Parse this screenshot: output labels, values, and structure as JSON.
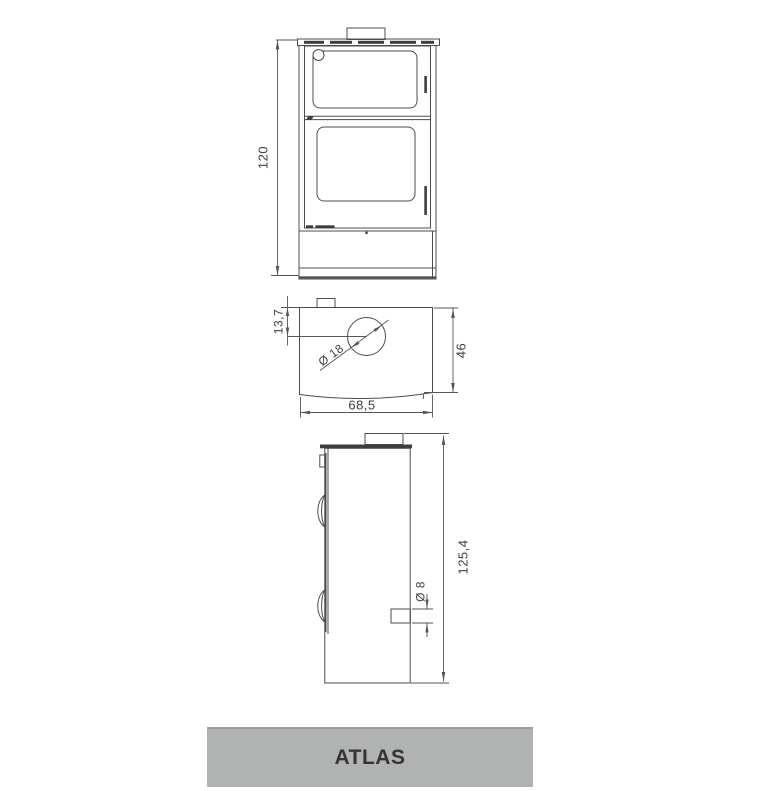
{
  "drawing": {
    "front_view": {
      "height_dim": "120"
    },
    "top_view": {
      "flue_offset_dim": "13,7",
      "flue_diameter_dim": "Ø 18",
      "depth_dim": "46",
      "width_dim": "68,5"
    },
    "side_view": {
      "height_dim": "125,4",
      "air_inlet_diameter_dim": "Ø 8"
    }
  },
  "banner": {
    "label": "ATLAS"
  },
  "colors": {
    "background": "#ffffff",
    "line": "#4c4c4c",
    "dim_line": "#565656",
    "dark_fill": "#3e3e3e",
    "text": "#3f3f3f",
    "banner_bg": "#b1b3b2",
    "banner_border": "#9c9e9d",
    "banner_text": "#343434"
  }
}
